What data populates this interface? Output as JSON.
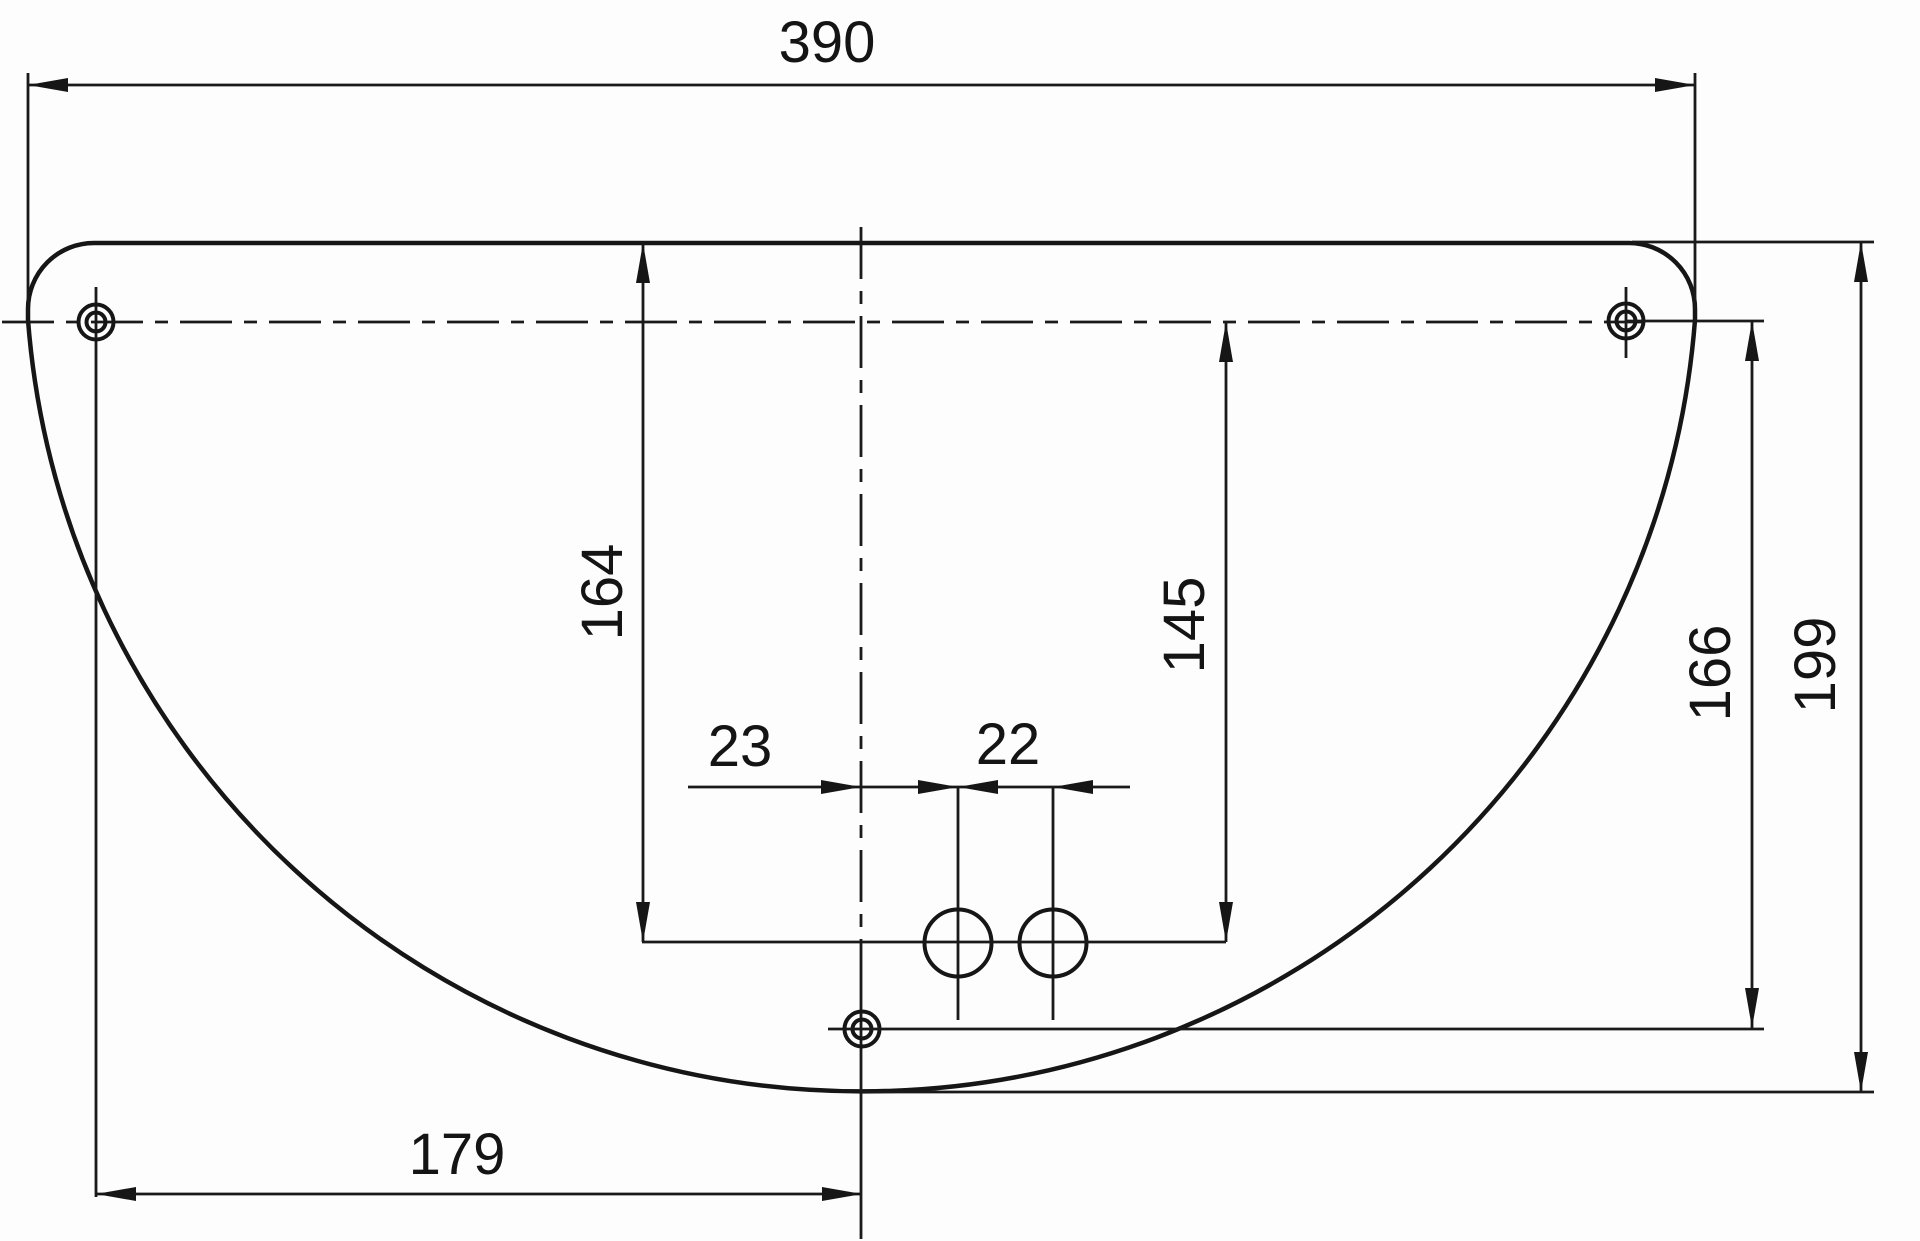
{
  "drawing": {
    "description": "Engineering dimension drawing of a D-shaped mounting plate with three cross-hair mounting holes and two small plain holes",
    "colors": {
      "background": "#fdfdfd",
      "line": "#161616"
    },
    "dims": {
      "overall_width": {
        "label": "390",
        "orientation": "horizontal",
        "meaning": "overall width of plate"
      },
      "top_to_small_holes": {
        "label": "164",
        "orientation": "vertical",
        "meaning": "top edge down to small-hole center line"
      },
      "holeline_to_small": {
        "label": "145",
        "orientation": "vertical",
        "meaning": "upper hole center line down to small-hole center line"
      },
      "center_to_small_hole": {
        "label": "23",
        "orientation": "horizontal",
        "meaning": "vertical center line to first small hole"
      },
      "small_hole_pitch": {
        "label": "22",
        "orientation": "horizontal",
        "meaning": "spacing between small holes"
      },
      "holeline_to_bottom_hole": {
        "label": "166",
        "orientation": "vertical",
        "meaning": "upper hole center line down to bottom hole center"
      },
      "top_to_bottom_edge": {
        "label": "199",
        "orientation": "vertical",
        "meaning": "top edge down to lowest point of plate"
      },
      "left_hole_to_center": {
        "label": "179",
        "orientation": "horizontal",
        "meaning": "left hole center to vertical center line"
      }
    }
  }
}
